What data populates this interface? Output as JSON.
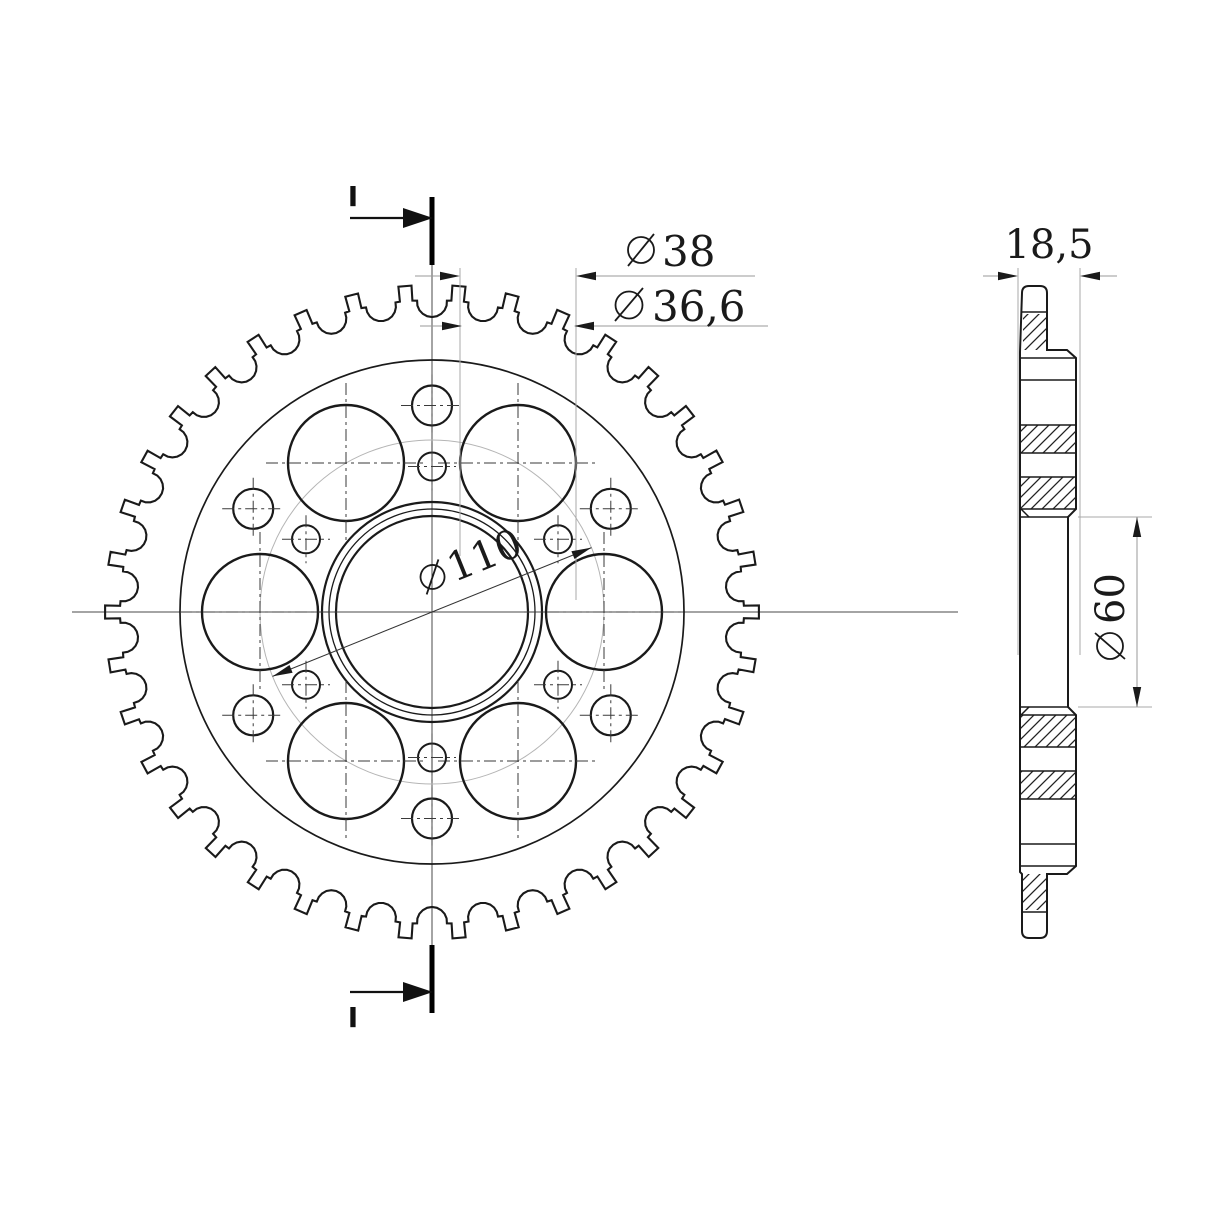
{
  "page": {
    "background": "#ffffff"
  },
  "drawing": {
    "kind": "technical-drawing",
    "subject": "chain sprocket, front view and sectioned side view",
    "teeth": 38,
    "large_holes": 6,
    "bolt_holes": 6,
    "relief_holes": 6,
    "colors": {
      "line": "#1a1a1a",
      "dimension": "#9a9a9a",
      "centerline": "#4a4a4a",
      "reference_circle": "#b5b5b5"
    },
    "front_view": {
      "section_marker_top": {
        "label": "I"
      },
      "section_marker_bottom": {
        "label": "I"
      },
      "dims": {
        "large_hole_outer": {
          "symbol": "⌀",
          "value": "38"
        },
        "large_hole_inner": {
          "symbol": "⌀",
          "value": "36,6"
        },
        "bolt_circle": {
          "symbol": "⌀",
          "value": "110"
        }
      }
    },
    "side_view": {
      "dims": {
        "width": {
          "value": "18,5"
        },
        "bore": {
          "symbol": "⌀",
          "value": "60"
        }
      }
    }
  }
}
